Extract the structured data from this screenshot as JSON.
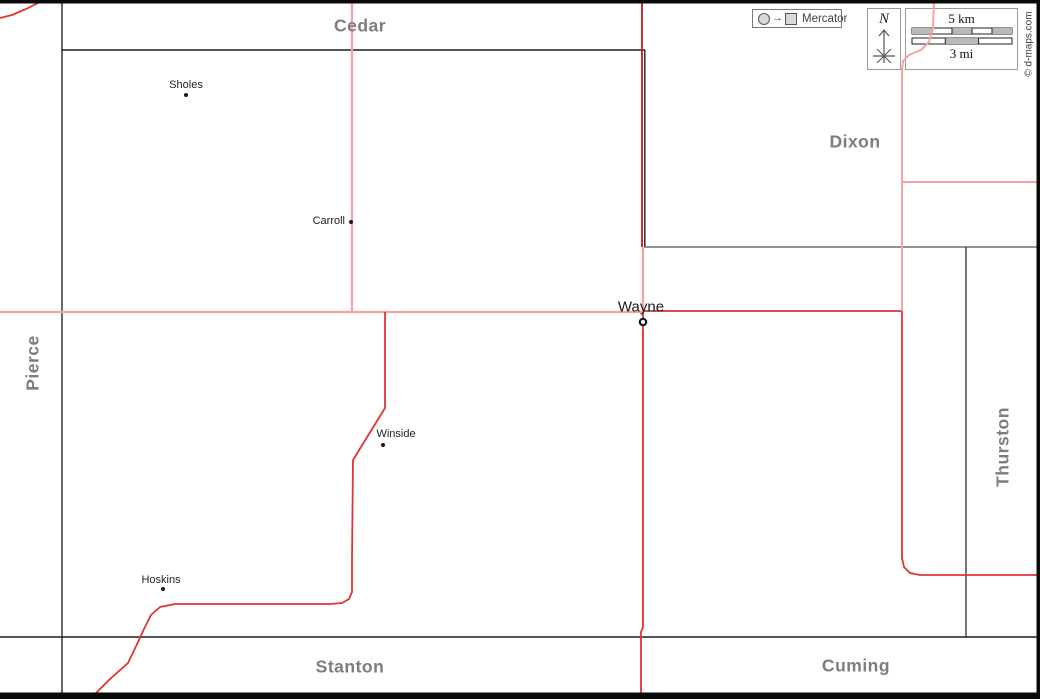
{
  "map": {
    "width": 1040,
    "height": 699,
    "background": "#ffffff",
    "frame": {
      "top_height": 3.5,
      "bottom_y": 692.5,
      "right_x": 1036.5,
      "color": "#0a0a0a"
    }
  },
  "colors": {
    "pink": "#f5a2a2",
    "red": "#e23333",
    "darkred": "#c81717",
    "black_line": "#1c1c1c",
    "dark_line": "#262626",
    "mid_line": "#3d3d3d",
    "gray_line": "#6f6f6f",
    "county_label": "#7d7d7d",
    "town_dot": "#1a1a1a"
  },
  "counties": [
    {
      "name": "Cedar",
      "x": 360,
      "y": 26,
      "rotated": false
    },
    {
      "name": "Dixon",
      "x": 855,
      "y": 142,
      "rotated": false
    },
    {
      "name": "Pierce",
      "x": 33,
      "y": 363,
      "rotated": true
    },
    {
      "name": "Thurston",
      "x": 1003,
      "y": 447,
      "rotated": true
    },
    {
      "name": "Stanton",
      "x": 350,
      "y": 667,
      "rotated": false
    },
    {
      "name": "Cuming",
      "x": 856,
      "y": 666,
      "rotated": false
    }
  ],
  "towns": [
    {
      "name": "Sholes",
      "type": "dot",
      "dot": [
        186,
        95
      ],
      "label": {
        "x": 186,
        "y": 85,
        "anchor": "middle",
        "big": false
      }
    },
    {
      "name": "Carroll",
      "type": "dot",
      "dot": [
        351,
        222
      ],
      "label": {
        "x": 345,
        "y": 221,
        "anchor": "end",
        "big": false
      }
    },
    {
      "name": "Wayne",
      "type": "seat",
      "dot": [
        643,
        322
      ],
      "label": {
        "x": 641,
        "y": 307,
        "anchor": "middle",
        "big": true
      }
    },
    {
      "name": "Winside",
      "type": "dot",
      "dot": [
        383,
        445
      ],
      "label": {
        "x": 396,
        "y": 434,
        "anchor": "middle",
        "big": false
      }
    },
    {
      "name": "Hoskins",
      "type": "dot",
      "dot": [
        163,
        589
      ],
      "label": {
        "x": 161,
        "y": 580,
        "anchor": "middle",
        "big": false
      }
    }
  ],
  "boundaries": [
    {
      "id": "pierce-east",
      "color": "dark_line",
      "width": 1.4,
      "points": [
        [
          62,
          0
        ],
        [
          62,
          693
        ]
      ]
    },
    {
      "id": "cedar-south",
      "color": "black_line",
      "width": 1.6,
      "points": [
        [
          62,
          50
        ],
        [
          645,
          50
        ]
      ]
    },
    {
      "id": "dixon-west",
      "color": "black_line",
      "width": 1.4,
      "points": [
        [
          644.8,
          50
        ],
        [
          644.8,
          247
        ]
      ]
    },
    {
      "id": "dixon-south",
      "color": "gray_line",
      "width": 1.4,
      "points": [
        [
          644,
          247
        ],
        [
          1037,
          247
        ]
      ]
    },
    {
      "id": "thurston-west",
      "color": "mid_line",
      "width": 1.4,
      "points": [
        [
          966,
          247
        ],
        [
          966,
          637
        ]
      ]
    },
    {
      "id": "stanton-north",
      "color": "black_line",
      "width": 1.6,
      "points": [
        [
          0,
          637
        ],
        [
          1037,
          637
        ]
      ]
    }
  ],
  "roads": [
    {
      "id": "carroll-road-north",
      "color": "pink",
      "width": 2.2,
      "points": [
        [
          352,
          0
        ],
        [
          352,
          312
        ]
      ]
    },
    {
      "id": "main-road-west",
      "color": "pink",
      "width": 2.2,
      "points": [
        [
          0,
          312
        ],
        [
          643,
          312
        ]
      ]
    },
    {
      "id": "north-road-overlap",
      "color": "darkred",
      "width": 1.8,
      "points": [
        [
          642,
          0
        ],
        [
          642,
          247
        ]
      ]
    },
    {
      "id": "north-link",
      "color": "pink",
      "width": 2.2,
      "points": [
        [
          643,
          247
        ],
        [
          643,
          311
        ]
      ]
    },
    {
      "id": "east-main-road",
      "color": "darkred",
      "width": 1.6,
      "points": [
        [
          644,
          311
        ],
        [
          902,
          311
        ]
      ]
    },
    {
      "id": "south-main-road",
      "color": "red",
      "width": 1.8,
      "points": [
        [
          643,
          312
        ],
        [
          643,
          627
        ],
        [
          641,
          632
        ],
        [
          641,
          693
        ]
      ]
    },
    {
      "id": "northeast-entry",
      "color": "pink",
      "width": 2.0,
      "points": [
        [
          934,
          0
        ],
        [
          933,
          28
        ],
        [
          929,
          42
        ],
        [
          921,
          50
        ],
        [
          909,
          55
        ],
        [
          903,
          61
        ],
        [
          902,
          70
        ],
        [
          902,
          311
        ]
      ]
    },
    {
      "id": "northeast-branch",
      "color": "pink",
      "width": 2.0,
      "points": [
        [
          902,
          182
        ],
        [
          1037,
          182
        ]
      ]
    },
    {
      "id": "southeast-road",
      "color": "red",
      "width": 1.8,
      "points": [
        [
          902,
          311
        ],
        [
          902,
          558
        ],
        [
          904,
          567
        ],
        [
          910,
          573
        ],
        [
          920,
          575
        ],
        [
          1037,
          575
        ]
      ]
    },
    {
      "id": "winside-hoskins-road",
      "color": "red",
      "width": 1.8,
      "points": [
        [
          385,
          312
        ],
        [
          385,
          408
        ],
        [
          353,
          460
        ],
        [
          352,
          560
        ],
        [
          352,
          592
        ],
        [
          349,
          599
        ],
        [
          342,
          603
        ],
        [
          330,
          604
        ],
        [
          175,
          604
        ],
        [
          160,
          607
        ],
        [
          151,
          615
        ],
        [
          144,
          629
        ],
        [
          139,
          640
        ],
        [
          128,
          663
        ],
        [
          110,
          679
        ],
        [
          96,
          693
        ]
      ]
    },
    {
      "id": "northwest-corner-road",
      "color": "red",
      "width": 1.8,
      "points": [
        [
          0,
          18
        ],
        [
          12,
          15
        ],
        [
          26,
          9
        ],
        [
          40,
          2
        ],
        [
          44,
          0
        ]
      ]
    }
  ],
  "legend": {
    "projection": "Mercator"
  },
  "compass": {
    "label": "N"
  },
  "scale": {
    "km_label": "5 km",
    "mi_label": "3 mi"
  },
  "copyright": "© d-maps.com"
}
